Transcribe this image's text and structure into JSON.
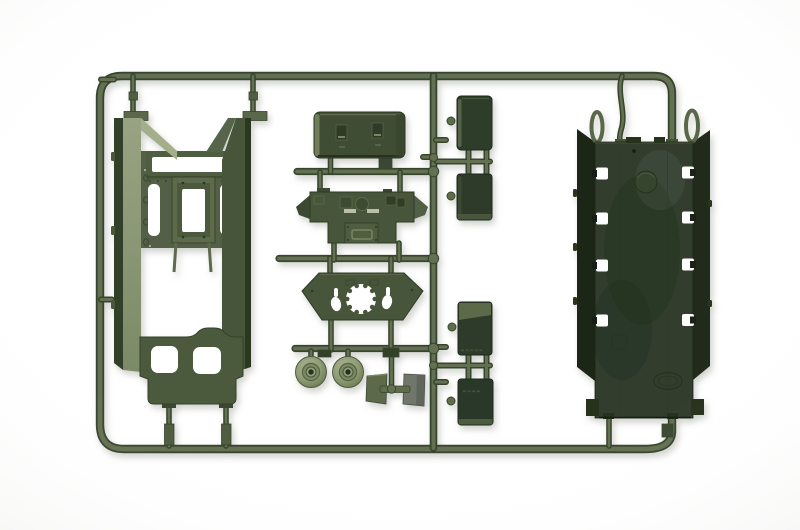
{
  "image": {
    "type": "product-photo",
    "alt": "Olive green injection-molded plastic model kit sprue (parts tree) for a military vehicle kit, photographed on a white background",
    "background_color": "#ffffff"
  },
  "sprue": {
    "plastic_colors": {
      "runner_olive": "#647051",
      "runner_shadow": "#39452d",
      "part_olive": "#46543a",
      "part_olive_deep": "#2f3c2b",
      "part_olive_light": "#8e987b",
      "hull_plate_green": "#303e2d",
      "sidewall_dark": "#1d2719",
      "wheel_highlight": "#a5b08a",
      "flap_gray": "#71766a"
    },
    "runner_frame": {
      "shape": "rounded-rectangle runner frame",
      "note": "right side of the frame is closed by the hull bottom plate part itself"
    },
    "parts": [
      {
        "name": "hull-side-frame",
        "position": "left",
        "features": "two vertical walls, top beam with window, central mount bracket, two oblong slots, bottom plate with two rounded square cutouts"
      },
      {
        "name": "roof-box",
        "position": "top-center",
        "features": "rounded rectangular box with two latch details"
      },
      {
        "name": "superstructure-plate",
        "position": "center",
        "features": "plate with angled side wings, hatch circle, two light slots and handle bracket"
      },
      {
        "name": "turret-ring-plate",
        "position": "center",
        "features": "trapezoid plate with castellated round opening, two oval holes and two slots"
      },
      {
        "name": "road-wheel",
        "position": "center-bottom",
        "count": 2
      },
      {
        "name": "mud-flap",
        "position": "center-bottom",
        "count": 2,
        "note": "one olive, one gray"
      },
      {
        "name": "stowage-box",
        "position": "right-of-center column",
        "count": 4,
        "note": "each with a small side knob, joined by H-connectors"
      },
      {
        "name": "hull-bottom-plate",
        "position": "right",
        "features": "long dark plate, eight square openings (4 per side), two corner tow loops, round emboss, faint square emboss, oval mold stamp, two bottom feet"
      }
    ]
  }
}
